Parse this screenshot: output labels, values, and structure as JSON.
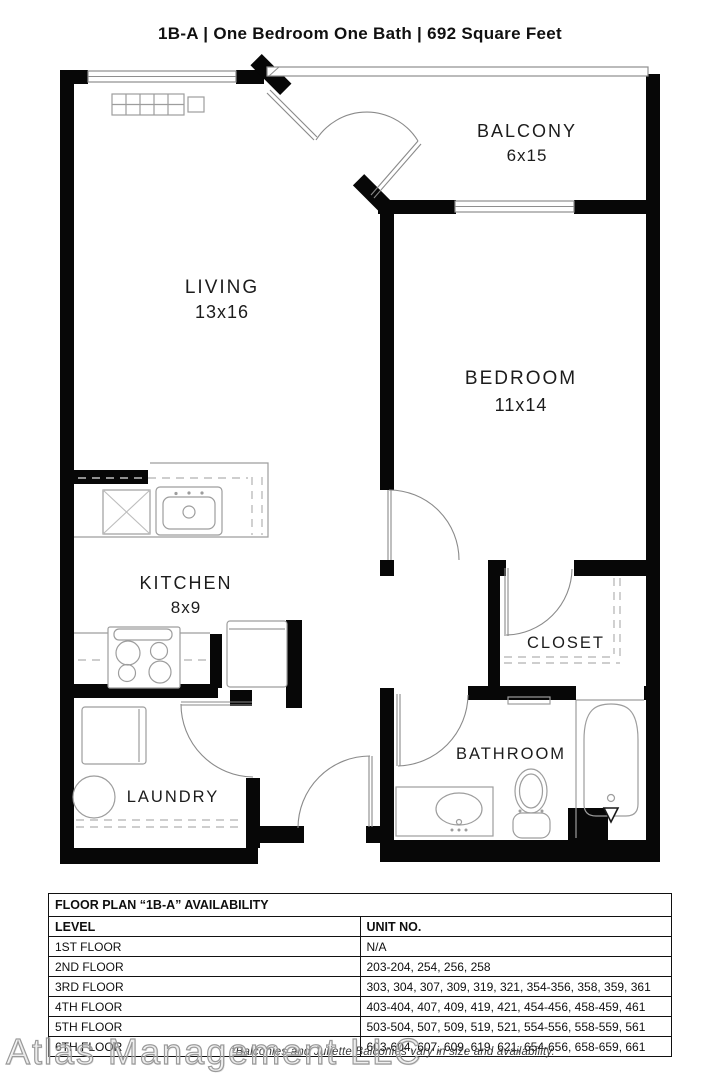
{
  "page_title": "1B-A | One Bedroom One Bath | 692 Square Feet",
  "rooms": {
    "balcony": {
      "name": "BALCONY",
      "dims": "6x15"
    },
    "living": {
      "name": "LIVING",
      "dims": "13x16"
    },
    "bedroom": {
      "name": "BEDROOM",
      "dims": "11x14"
    },
    "kitchen": {
      "name": "KITCHEN",
      "dims": "8x9"
    },
    "closet": {
      "name": "CLOSET"
    },
    "bathroom": {
      "name": "BATHROOM"
    },
    "laundry": {
      "name": "LAUNDRY"
    }
  },
  "availability": {
    "title": "FLOOR PLAN “1B-A” AVAILABILITY",
    "columns": [
      "LEVEL",
      "UNIT NO."
    ],
    "rows": [
      {
        "level": "1ST FLOOR",
        "units": "N/A"
      },
      {
        "level": "2ND FLOOR",
        "units": "203-204, 254, 256, 258"
      },
      {
        "level": "3RD FLOOR",
        "units": "303, 304, 307, 309, 319, 321, 354-356, 358, 359, 361"
      },
      {
        "level": "4TH FLOOR",
        "units": "403-404, 407, 409, 419, 421, 454-456, 458-459, 461"
      },
      {
        "level": "5TH FLOOR",
        "units": "503-504, 507, 509, 519, 521, 554-556, 558-559, 561"
      },
      {
        "level": "6TH FLOOR",
        "units": "603-604, 607, 609, 619, 621, 654-656, 658-659, 661"
      }
    ]
  },
  "footnote": "*Balconies and Juliette Balconies vary in size and availability.",
  "watermark": "Atlas Management LLC",
  "colors": {
    "wall": "#070707",
    "line": "#8e8e8e",
    "label": "#1c1c1c"
  }
}
